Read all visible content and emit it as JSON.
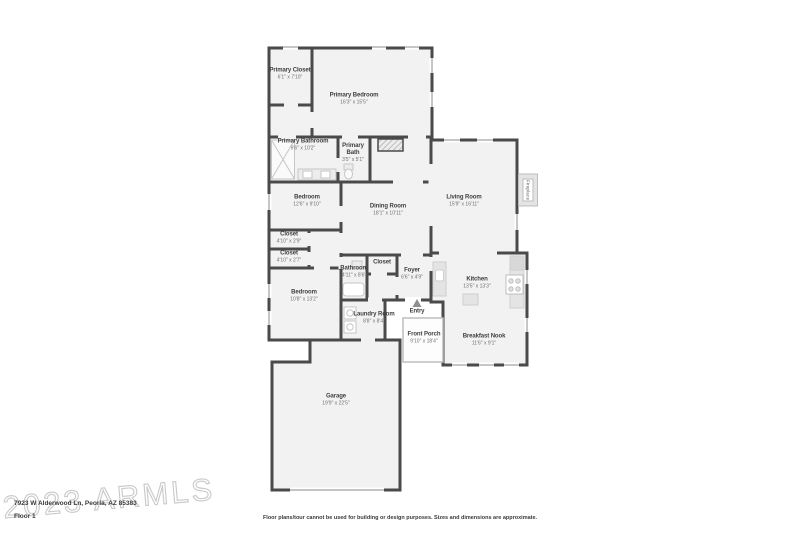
{
  "colors": {
    "wall": "#4a4a4a",
    "room_fill": "#f2f2f2",
    "fixture_fill": "#e4e4e4",
    "fixture_stroke": "#c6c6c6",
    "window_line": "#a0a0a0",
    "watermark": "#c9c9c9",
    "text_dark": "#3f3f3f",
    "text_dim": "#707070"
  },
  "watermark": {
    "text": "2023 ARMLS"
  },
  "footer": {
    "address": "7923 W Alderwood Ln, Peoria, AZ 85383",
    "floor_label": "Floor 1",
    "disclaimer": "Floor plans/tour cannot be used for building or design purposes. Sizes and dimensions are approximate."
  },
  "rooms": [
    {
      "name": "Primary Closet",
      "dims": "6'1\" x 7'10\""
    },
    {
      "name": "Primary Bedroom",
      "dims": "16'3\" x 15'5\""
    },
    {
      "name": "Primary Bathroom",
      "dims": "9'6\" x 10'2\""
    },
    {
      "name": "Primary Bath",
      "dims": "3'5\" x 5'1\""
    },
    {
      "name": "Bedroom",
      "dims": "12'6\" x 9'10\""
    },
    {
      "name": "Dining Room",
      "dims": "18'1\" x 10'11\""
    },
    {
      "name": "Living Room",
      "dims": "15'9\" x 16'11\""
    },
    {
      "name": "Closet",
      "dims": "4'10\" x 2'9\""
    },
    {
      "name": "Closet",
      "dims": "4'10\" x 2'7\""
    },
    {
      "name": "Bathroom",
      "dims": "4'11\" x 8'6\""
    },
    {
      "name": "Closet",
      "dims": ""
    },
    {
      "name": "Foyer",
      "dims": "6'6\" x 4'9\""
    },
    {
      "name": "Kitchen",
      "dims": "13'5\" x 13'3\""
    },
    {
      "name": "Bedroom",
      "dims": "10'8\" x 13'2\""
    },
    {
      "name": "Laundry Room",
      "dims": "8'8\" x 8'4\""
    },
    {
      "name": "Entry",
      "dims": ""
    },
    {
      "name": "Front Porch",
      "dims": "9'10\" x 18'4\""
    },
    {
      "name": "Breakfast Nook",
      "dims": "11'6\" x 9'1\""
    },
    {
      "name": "Garage",
      "dims": "19'9\" x 22'5\""
    },
    {
      "name": "Fireplace",
      "dims": ""
    }
  ]
}
